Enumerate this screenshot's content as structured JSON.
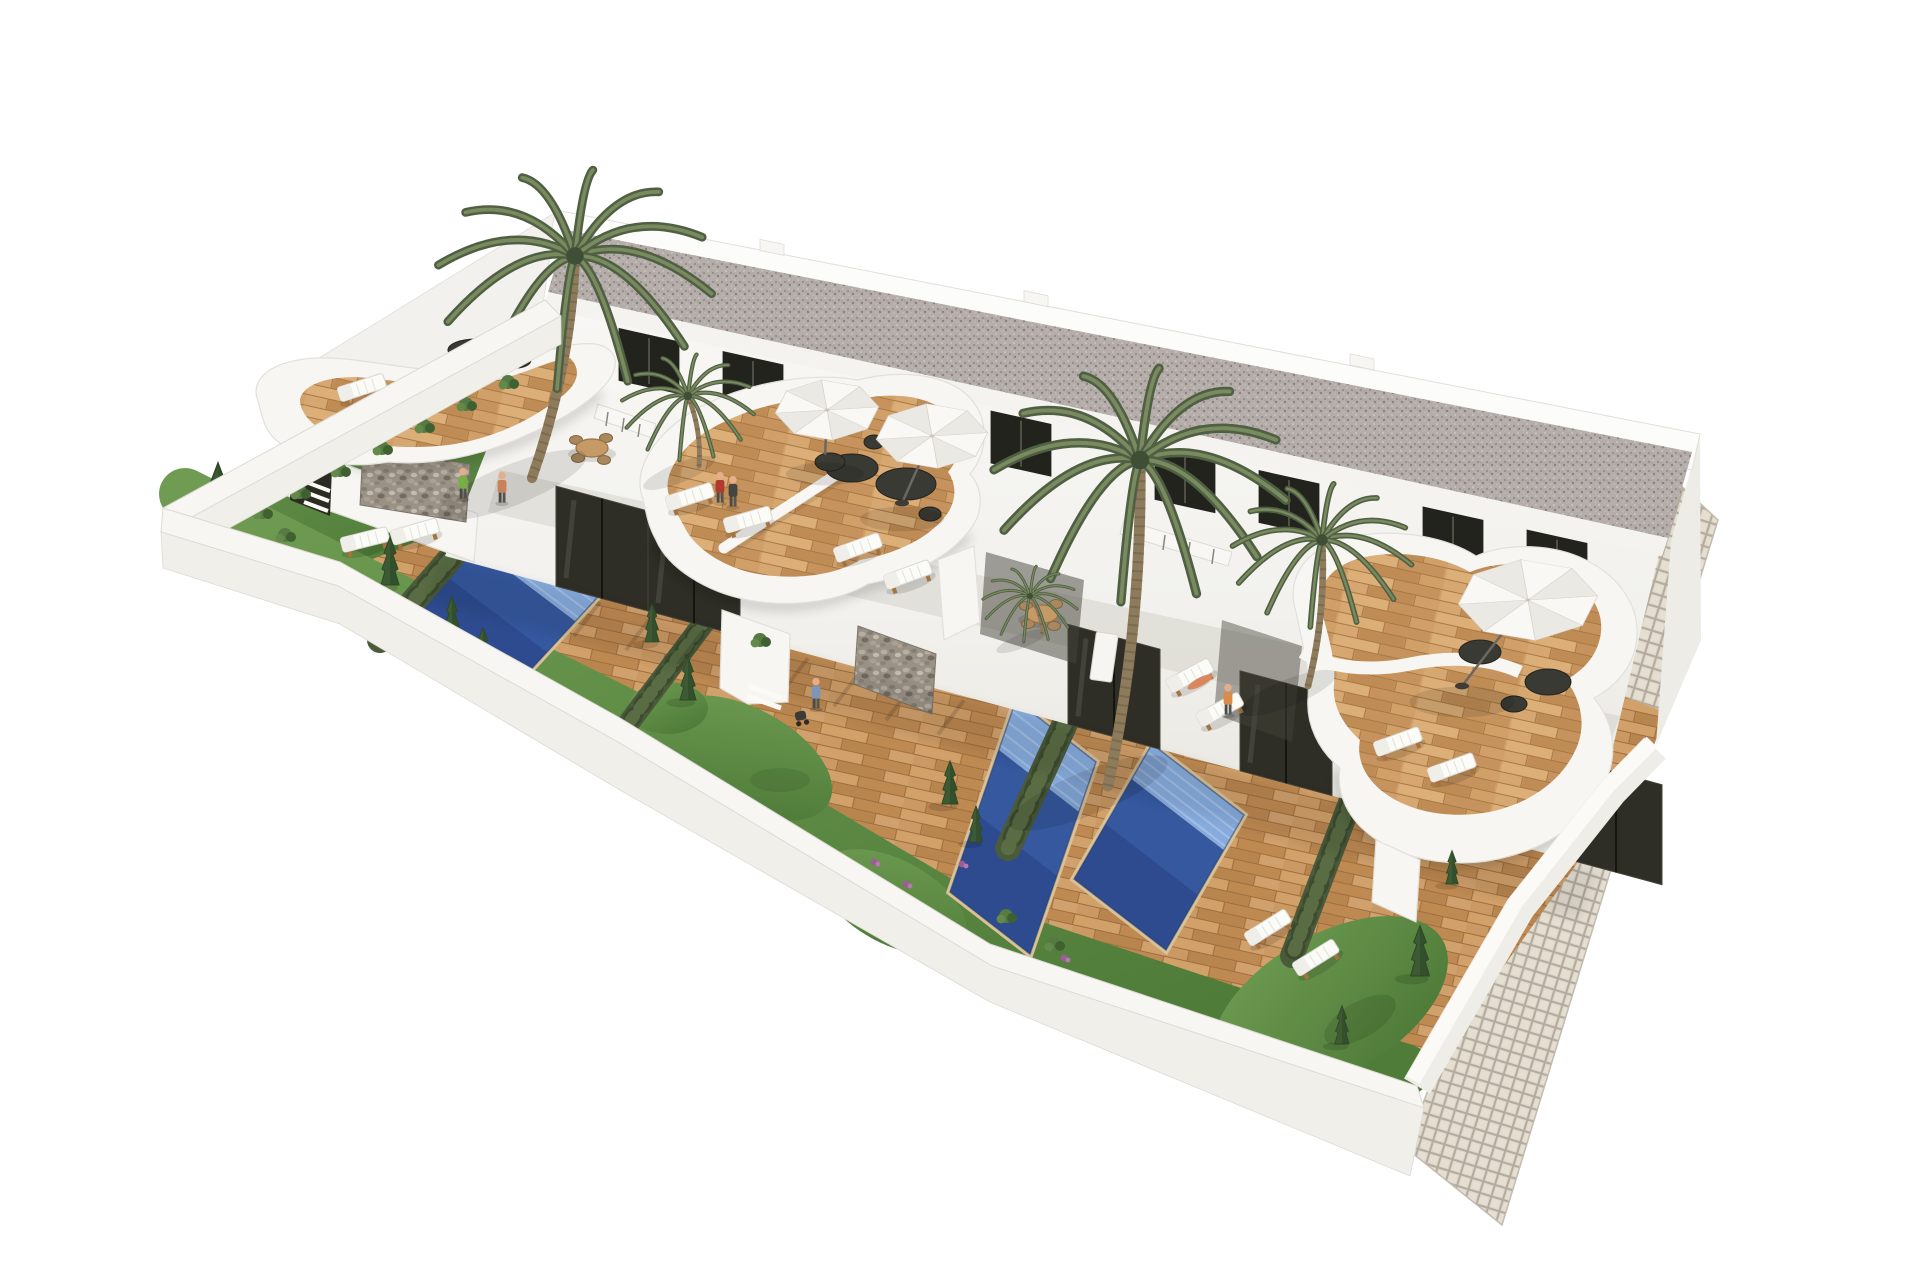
{
  "meta": {
    "title": "Aerial 3D architectural rendering of a modern white townhouse development with private pools, wooden decks, curved balconies and palm trees",
    "background": "#ffffff"
  },
  "palette": {
    "background": "#ffffff",
    "wall_white": "#f7f6f3",
    "wall_face": "#f0efea",
    "wall_edge": "#dcdad3",
    "roof_gravel": "#b5adaa",
    "facade_top": "#f8f7f4",
    "facade_bottom": "#ebe9e4",
    "window_dark": "#23231d",
    "door_glass": "#2e2e26",
    "deck_wood": "#c8935c",
    "deck_wood_light": "#d4a571",
    "pool_light": "#86abdc",
    "pool_dark": "#35589f",
    "pool_deep": "#2c4a8c",
    "grass_light": "#6f9c52",
    "grass_dark": "#4f7c39",
    "hedge_green": "#4a5a3b",
    "palm_green": "#5a6a4c",
    "stone_gabion": "#9a9286",
    "tile_paving": "#dcd6ca",
    "umbrella_white": "#f9f8f5",
    "furniture_dark": "#3a3a34",
    "lounger_white": "#fbfbf8"
  },
  "scene": {
    "building": {
      "floors": 2,
      "roof_texture": "gravel",
      "windows_upper_x": [
        618,
        722,
        886,
        990,
        1154,
        1258,
        1422,
        1526
      ],
      "window_size": {
        "w": 62,
        "h": 54,
        "slope": 0.222,
        "intercept": 190
      },
      "doors_ground_x": [
        556,
        648,
        1068,
        1240,
        1430,
        1570
      ],
      "door_size": {
        "w": 92,
        "h": 100,
        "slope": 0.27,
        "intercept": 436
      },
      "chimneys_x": [
        760,
        1024,
        1350
      ]
    },
    "pools": [
      {
        "name": "pool-left",
        "points": [
          [
            502,
            506
          ],
          [
            608,
            586
          ],
          [
            512,
            690
          ],
          [
            406,
            610
          ]
        ],
        "light_frac": 0.34
      },
      {
        "name": "pool-center",
        "points": [
          [
            1016,
            700
          ],
          [
            1096,
            762
          ],
          [
            1030,
            954
          ],
          [
            950,
            892
          ]
        ],
        "light_frac": 0.26
      },
      {
        "name": "pool-right",
        "points": [
          [
            1152,
            744
          ],
          [
            1244,
            815
          ],
          [
            1166,
            950
          ],
          [
            1074,
            879
          ]
        ],
        "light_frac": 0.26
      }
    ],
    "hedges": [
      {
        "name": "hedge-1",
        "from": [
          596,
          390
        ],
        "to": [
          380,
          640
        ],
        "width": 26
      },
      {
        "name": "hedge-2",
        "from": [
          706,
          620
        ],
        "to": [
          616,
          740
        ],
        "width": 22
      },
      {
        "name": "hedge-3",
        "from": [
          1128,
          586
        ],
        "to": [
          1008,
          848
        ],
        "width": 26
      },
      {
        "name": "hedge-4",
        "from": [
          1392,
          692
        ],
        "to": [
          1292,
          956
        ],
        "width": 24
      }
    ],
    "palms": [
      {
        "name": "palm-large-left",
        "x": 575,
        "y": 256,
        "scale": 1.45,
        "trunk_base": [
          532,
          478
        ]
      },
      {
        "name": "palm-small-left",
        "x": 688,
        "y": 396,
        "scale": 0.7,
        "trunk_base": [
          699,
          466
        ]
      },
      {
        "name": "palm-large-center",
        "x": 1140,
        "y": 460,
        "scale": 1.55,
        "trunk_base": [
          1108,
          786
        ]
      },
      {
        "name": "palm-right",
        "x": 1322,
        "y": 540,
        "scale": 0.95,
        "trunk_base": [
          1308,
          686
        ]
      },
      {
        "name": "palm-deck-small",
        "x": 1030,
        "y": 596,
        "scale": 0.5,
        "trunk_base": [
          1042,
          634
        ]
      }
    ],
    "conifers": [
      [
        218,
        540,
        1.6
      ],
      [
        390,
        585,
        1.0
      ],
      [
        452,
        640,
        0.9
      ],
      [
        483,
        666,
        0.8
      ],
      [
        652,
        642,
        0.8
      ],
      [
        688,
        700,
        0.9
      ],
      [
        950,
        804,
        0.9
      ],
      [
        976,
        842,
        0.75
      ],
      [
        1420,
        976,
        1.05
      ],
      [
        1342,
        1044,
        0.8
      ],
      [
        1452,
        884,
        0.7
      ]
    ],
    "bushes": [
      [
        262,
        512
      ],
      [
        300,
        492
      ],
      [
        340,
        470
      ],
      [
        382,
        448
      ],
      [
        424,
        426
      ],
      [
        466,
        404
      ],
      [
        508,
        382
      ],
      [
        285,
        535
      ],
      [
        1006,
        916
      ],
      [
        1054,
        944
      ],
      [
        760,
        640
      ]
    ],
    "flowers": [
      [
        874,
        862
      ],
      [
        906,
        884
      ],
      [
        1064,
        958
      ],
      [
        1122,
        1006
      ],
      [
        962,
        864
      ]
    ],
    "umbrellas": [
      {
        "name": "parasol-center-1",
        "cx": 827,
        "cy": 410,
        "r": 52,
        "pole": [
          825,
          458
        ]
      },
      {
        "name": "parasol-center-2",
        "cx": 932,
        "cy": 436,
        "r": 56,
        "pole": [
          902,
          503
        ]
      },
      {
        "name": "parasol-right",
        "cx": 1528,
        "cy": 600,
        "r": 70,
        "pole": [
          1462,
          686
        ]
      }
    ],
    "loungers": [
      [
        362,
        388,
        -18
      ],
      [
        418,
        403,
        -14
      ],
      [
        365,
        540,
        -14
      ],
      [
        415,
        532,
        -16
      ],
      [
        690,
        497,
        -18
      ],
      [
        748,
        520,
        -16
      ],
      [
        858,
        548,
        -20
      ],
      [
        908,
        575,
        -20
      ],
      [
        1190,
        676,
        -28
      ],
      [
        1220,
        710,
        -28
      ],
      [
        1398,
        742,
        -20
      ],
      [
        1452,
        768,
        -20
      ],
      [
        1268,
        928,
        -32
      ],
      [
        1316,
        958,
        -32
      ]
    ],
    "dining_sets": [
      [
        592,
        448
      ],
      [
        1042,
        614
      ]
    ],
    "dark_furniture": [
      [
        852,
        468,
        26,
        14
      ],
      [
        906,
        484,
        30,
        16
      ],
      [
        874,
        442,
        10,
        7
      ],
      [
        930,
        514,
        11,
        7
      ],
      [
        1480,
        652,
        21,
        12
      ],
      [
        1548,
        682,
        23,
        13
      ],
      [
        1514,
        704,
        13,
        8
      ],
      [
        476,
        350,
        28,
        11
      ],
      [
        516,
        360,
        15,
        8
      ],
      [
        830,
        462,
        15,
        9
      ]
    ],
    "people": [
      {
        "x": 720,
        "y": 502,
        "shirt": "#b03a2e"
      },
      {
        "x": 733,
        "y": 506,
        "shirt": "#45453f"
      },
      {
        "x": 816,
        "y": 708,
        "shirt": "#7d96b8"
      },
      {
        "x": 463,
        "y": 498,
        "shirt": "#76b043"
      },
      {
        "x": 502,
        "y": 502,
        "shirt": "#c7825a"
      },
      {
        "x": 1228,
        "y": 714,
        "shirt": "#d98c4a"
      }
    ],
    "lying_people": [
      [
        1200,
        682,
        -28
      ]
    ],
    "stroller": [
      802,
      720
    ]
  }
}
